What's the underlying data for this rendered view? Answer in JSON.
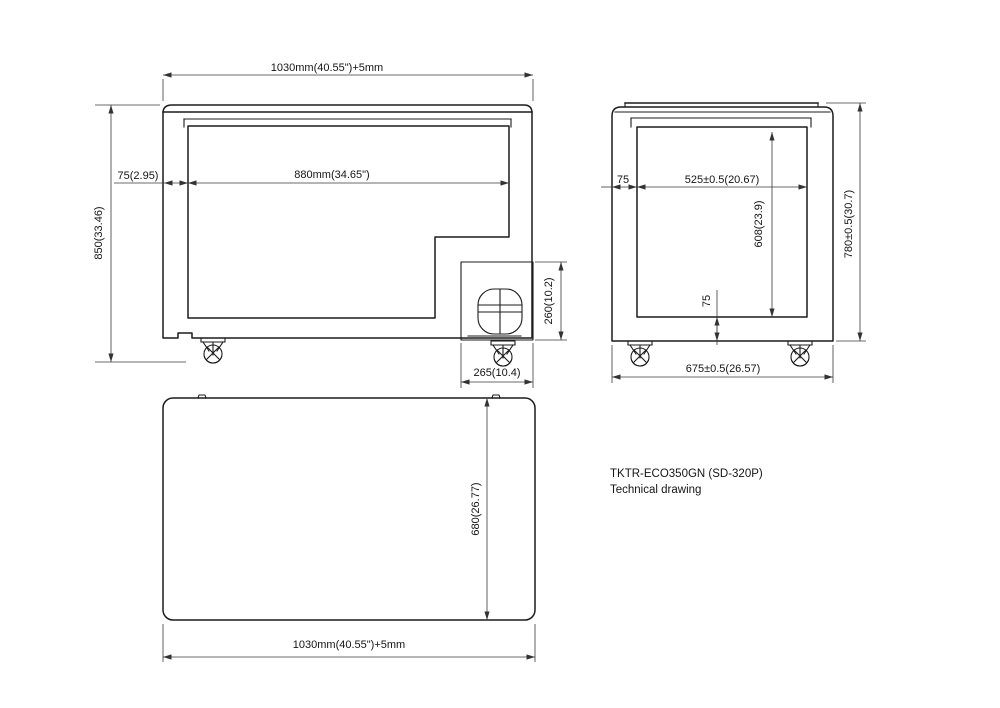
{
  "drawing": {
    "model_line1": "TKTR-ECO350GN (SD-320P)",
    "model_line2": "Technical drawing"
  },
  "front_view": {
    "dim_overall_width": "1030mm(40.55\")+5mm",
    "dim_inner_width": "880mm(34.65\")",
    "dim_wall_thickness": "75(2.95)",
    "dim_overall_height": "850(33.46)",
    "dim_compressor_height": "260(10.2)",
    "dim_compressor_width": "265(10.4)"
  },
  "side_view": {
    "dim_wall_top": "75",
    "dim_inner_depth": "525±0.5(20.67)",
    "dim_inner_height": "608(23.9)",
    "dim_outer_height": "780±0.5(30.7)",
    "dim_bottom_wall": "75",
    "dim_outer_depth": "675±0.5(26.57)"
  },
  "top_view": {
    "dim_depth": "680(26.77)",
    "dim_overall_width": "1030mm(40.55\")+5mm"
  },
  "colors": {
    "line": "#1c1c1c",
    "dim_line": "#3a3a3a",
    "background": "#ffffff"
  }
}
